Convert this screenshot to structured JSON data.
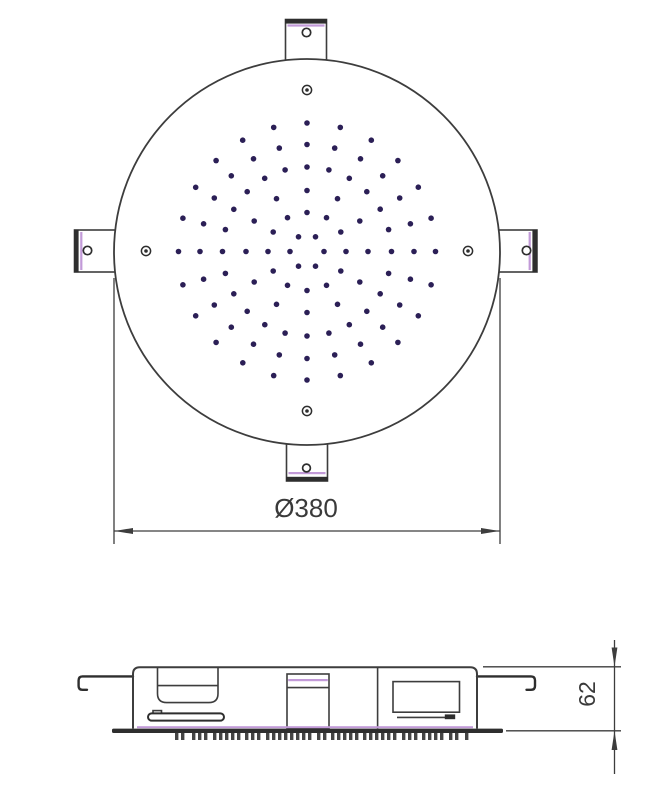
{
  "drawing": {
    "type": "shower-head-technical-drawing",
    "colors": {
      "line": "#3d3d3d",
      "edge": "#2e2e2e",
      "accent": "#c29ad8",
      "dot": "#2b1f56",
      "text": "#3a3a3a",
      "background": "#ffffff"
    },
    "views": {
      "top": {
        "label": "top-view",
        "diameter_dimension": {
          "label": "Ø380",
          "value": 380
        },
        "face_circle": {
          "cx": 307,
          "cy": 252,
          "r": 193
        },
        "nozzle_pattern": {
          "cx": 307,
          "cy": 251.5,
          "dot_radius": 2.8,
          "rings": [
            {
              "r": 17,
              "count": 6
            },
            {
              "r": 39,
              "count": 12
            },
            {
              "r": 61,
              "count": 12
            },
            {
              "r": 84.5,
              "count": 24
            },
            {
              "r": 107,
              "count": 24
            },
            {
              "r": 128.5,
              "count": 24
            }
          ]
        },
        "screw_holes": [
          {
            "cx": 307,
            "cy": 90
          },
          {
            "cx": 146,
            "cy": 251
          },
          {
            "cx": 468,
            "cy": 251
          },
          {
            "cx": 307,
            "cy": 411
          }
        ]
      },
      "side": {
        "label": "side-view",
        "height_dimension": {
          "label": "62",
          "value": 62
        },
        "teeth": {
          "y": 733,
          "width": 3.4,
          "height": 7,
          "pitch": 6,
          "groups": [
            {
              "x": 175,
              "n": 2
            },
            {
              "x": 192,
              "n": 3
            },
            {
              "x": 213,
              "n": 5
            },
            {
              "x": 245,
              "n": 3
            },
            {
              "x": 266,
              "n": 8
            },
            {
              "x": 317,
              "n": 2
            },
            {
              "x": 331,
              "n": 5
            },
            {
              "x": 363,
              "n": 6
            },
            {
              "x": 402,
              "n": 3
            },
            {
              "x": 422,
              "n": 4
            },
            {
              "x": 449,
              "n": 2
            },
            {
              "x": 465,
              "n": 1
            }
          ]
        }
      }
    }
  }
}
